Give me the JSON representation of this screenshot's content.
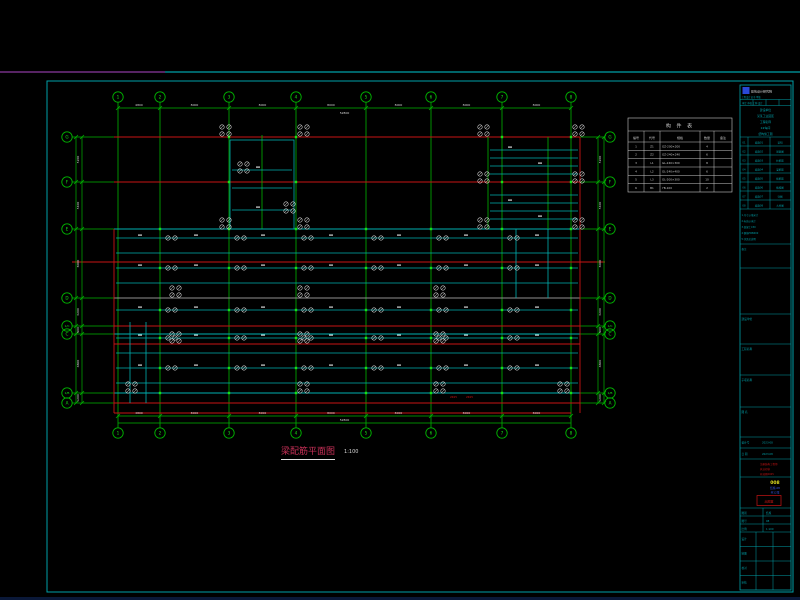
{
  "app": {
    "type": "cad-model-space",
    "background": "#000000"
  },
  "colors": {
    "green": "#00b400",
    "bright_green": "#17e017",
    "red": "#c81414",
    "cyan": "#00b0b0",
    "teal_border": "#00a0a8",
    "magenta_line": "#8b3aa0",
    "white": "#d6d6d6",
    "gray": "#8f8f8f",
    "title_magenta": "#c73057",
    "yellow": "#e0e020",
    "blue_text": "#3a5cf0",
    "logo_blue": "#2a48d8",
    "table_white": "#c8c8c8"
  },
  "frame": {
    "top_line_y": 72,
    "magenta_span": [
      0,
      165
    ],
    "teal_span": [
      165,
      800
    ],
    "border": {
      "x": 47,
      "y": 81,
      "w": 746,
      "h": 511
    },
    "bottom_strip_y": 597
  },
  "plan": {
    "x_axes": {
      "positions": [
        118,
        160,
        229,
        296,
        366,
        431,
        502,
        571
      ],
      "labels": [
        "1",
        "2",
        "3",
        "4",
        "5",
        "6",
        "7",
        "8"
      ],
      "top_bubble_y": 97,
      "bottom_bubble_y": 433,
      "line_y1": 102,
      "line_y2": 428
    },
    "y_axes": {
      "positions": [
        137,
        182,
        229,
        298,
        326,
        334,
        393,
        403
      ],
      "labels": [
        "G",
        "F",
        "E",
        "D",
        "1/C",
        "C",
        "1/B",
        "A"
      ],
      "left_bubble_x": 67,
      "right_bubble_x": 610,
      "line_x1": 72,
      "line_x2": 605,
      "mid_colors": [
        "red",
        "red",
        "cyan",
        "gray",
        "red",
        "cyan",
        "cyan",
        "red"
      ],
      "mid_span": [
        114,
        580
      ]
    },
    "red_lines": {
      "horizontal": [
        {
          "y": 413,
          "x1": 114,
          "x2": 571
        },
        {
          "y": 262,
          "x1": 72,
          "x2": 605
        },
        {
          "y": 344,
          "x1": 114,
          "x2": 580
        }
      ],
      "vertical": [
        {
          "x": 114,
          "y1": 229,
          "y2": 413
        },
        {
          "x": 580,
          "y1": 137,
          "y2": 413
        }
      ]
    },
    "green_verticals": [
      {
        "x": 262,
        "y1": 135,
        "y2": 229
      },
      {
        "x": 488,
        "y1": 137,
        "y2": 229
      },
      {
        "x": 548,
        "y1": 137,
        "y2": 229
      }
    ],
    "cyan_beams_body": {
      "ys": [
        238,
        253,
        268,
        283,
        310,
        338,
        353,
        368,
        383
      ],
      "x1": 116,
      "x2": 578
    },
    "cyan_right_block": {
      "ys": [
        150,
        158,
        166,
        174,
        195,
        203,
        211,
        219
      ],
      "x1": 490,
      "x2": 578
    },
    "tower": {
      "box": [
        230,
        140,
        64,
        89
      ],
      "line_ys": [
        170,
        188,
        210
      ],
      "x1": 232,
      "x2": 292
    },
    "cyan_verticals": [
      {
        "x": 516,
        "y1": 229,
        "y2": 298
      },
      {
        "x": 548,
        "y1": 229,
        "y2": 298
      },
      {
        "x": 130,
        "y1": 322,
        "y2": 403
      },
      {
        "x": 146,
        "y1": 322,
        "y2": 403
      }
    ],
    "node_rows": [
      229,
      268,
      310,
      338,
      368,
      393
    ],
    "node_cols": [
      160,
      229,
      296,
      366,
      431,
      502,
      571
    ],
    "node_rows_upper": [
      137,
      182
    ],
    "node_cols_upper": [
      229,
      296,
      502,
      571
    ],
    "symbol_pair_rows": [
      238,
      268,
      310,
      338,
      368
    ],
    "symbol_pair_cols": [
      168,
      237,
      304,
      374,
      439,
      510
    ],
    "symbol_clusters": [
      [
        172,
        294
      ],
      [
        300,
        294
      ],
      [
        436,
        294
      ],
      [
        172,
        340
      ],
      [
        300,
        340
      ],
      [
        436,
        340
      ],
      [
        222,
        133
      ],
      [
        300,
        133
      ],
      [
        222,
        226
      ],
      [
        300,
        226
      ],
      [
        480,
        133
      ],
      [
        575,
        133
      ],
      [
        480,
        226
      ],
      [
        575,
        226
      ],
      [
        480,
        180
      ],
      [
        575,
        180
      ],
      [
        128,
        390
      ],
      [
        300,
        390
      ],
      [
        436,
        390
      ],
      [
        560,
        390
      ],
      [
        240,
        170
      ],
      [
        286,
        210
      ]
    ],
    "tick_rows": [
      238,
      268,
      310,
      338,
      368
    ],
    "tick_cols": [
      140,
      196,
      263,
      331,
      399,
      466,
      537
    ],
    "extra_ticks": [
      [
        510,
        150
      ],
      [
        540,
        166
      ],
      [
        510,
        203
      ],
      [
        540,
        219
      ],
      [
        258,
        170
      ],
      [
        258,
        210
      ]
    ],
    "red_annotations": [
      {
        "x": 450,
        "y": 398,
        "text": "2Φ25"
      },
      {
        "x": 466,
        "y": 398,
        "text": "2Φ25"
      }
    ]
  },
  "dimensions": {
    "top": {
      "line_y": 108,
      "text_y": 106,
      "total_y": 114,
      "values": [
        "4800",
        "8000",
        "8000",
        "8000",
        "8000",
        "8000",
        "8000"
      ],
      "total": "52800"
    },
    "bottom": {
      "line_y": 416,
      "text_y": 414,
      "line2_y": 423,
      "total_y": 421,
      "values": [
        "4800",
        "8000",
        "8000",
        "8000",
        "8000",
        "8000",
        "8000"
      ],
      "total": "52800"
    },
    "left": {
      "line_x": 76,
      "line2_x": 82,
      "values": [
        "5200",
        "5400",
        "8000",
        "3200",
        "900",
        "6800",
        "1200"
      ]
    },
    "right": {
      "line_x": 598,
      "line2_x": 604,
      "values": [
        "5200",
        "5400",
        "8000",
        "3200",
        "900",
        "6800",
        "1200"
      ]
    }
  },
  "schedule_table": {
    "x": 628,
    "y": 118,
    "w": 104,
    "h": 74,
    "title": "构 件 表",
    "headers": [
      "编号",
      "代号",
      "规格",
      "数量",
      "备注"
    ],
    "col_splits": [
      16,
      32,
      72,
      86
    ],
    "rows": [
      [
        "1",
        "Z1",
        "GZ-200×200",
        "4",
        ""
      ],
      [
        "2",
        "Z2",
        "GZ-240×240",
        "6",
        ""
      ],
      [
        "3",
        "L1",
        "GL-240×300",
        "8",
        ""
      ],
      [
        "4",
        "L2",
        "GL-240×400",
        "6",
        ""
      ],
      [
        "5",
        "L3",
        "GL-200×300",
        "10",
        ""
      ],
      [
        "6",
        "B1",
        "YB-100",
        "2",
        ""
      ]
    ]
  },
  "title_block": {
    "x": 740,
    "y": 85,
    "w": 51,
    "h": 505,
    "logo_text": "建筑设计研究院",
    "cert_line": "工程设计证书 甲级",
    "fields_row": "审定 审核 工种 设计",
    "project_lines": [
      "建设单位",
      "某某工业园区",
      "工程名称",
      "2#车间",
      "结构施工图"
    ],
    "sheet_table_rows": [
      [
        "01",
        "结施01",
        "说明"
      ],
      [
        "02",
        "结施02",
        "基础图"
      ],
      [
        "03",
        "结施03",
        "柱配筋"
      ],
      [
        "04",
        "结施04",
        "梁配筋"
      ],
      [
        "05",
        "结施05",
        "板配筋"
      ],
      [
        "06",
        "结施06",
        "楼梯图"
      ],
      [
        "07",
        "结施07",
        "详图"
      ],
      [
        "08",
        "结施08",
        "大样图"
      ]
    ],
    "notes": [
      "1.尺寸以毫米计",
      "2.标高以米计",
      "3.混凝土C30",
      "4.钢筋HRB400",
      "5.详见总说明"
    ],
    "box_labels": [
      "建设单位",
      "工程名称",
      "子项名称",
      "图 名"
    ],
    "box_divider_ys": [
      268,
      314,
      344,
      375,
      407
    ],
    "info_rows": [
      [
        "设计号",
        "2023-08"
      ],
      [
        "日 期",
        "2023.08"
      ]
    ],
    "red_lines": [
      "注册结构工程师",
      "执业印章",
      "有效期2025"
    ],
    "yellow_text": "008",
    "blue_lines": [
      "结施-08",
      "共12张"
    ],
    "stamp_text": "出图章",
    "grid_rows": [
      [
        "图别",
        "结施"
      ],
      [
        "图号",
        "08"
      ],
      [
        "比例",
        "1:100"
      ]
    ],
    "staff_rows": [
      [
        "设计",
        ""
      ],
      [
        "制图",
        ""
      ],
      [
        "校对",
        ""
      ],
      [
        "审核",
        ""
      ]
    ]
  },
  "drawing_title": {
    "text": "梁配筋平面图",
    "scale": "1:100"
  }
}
